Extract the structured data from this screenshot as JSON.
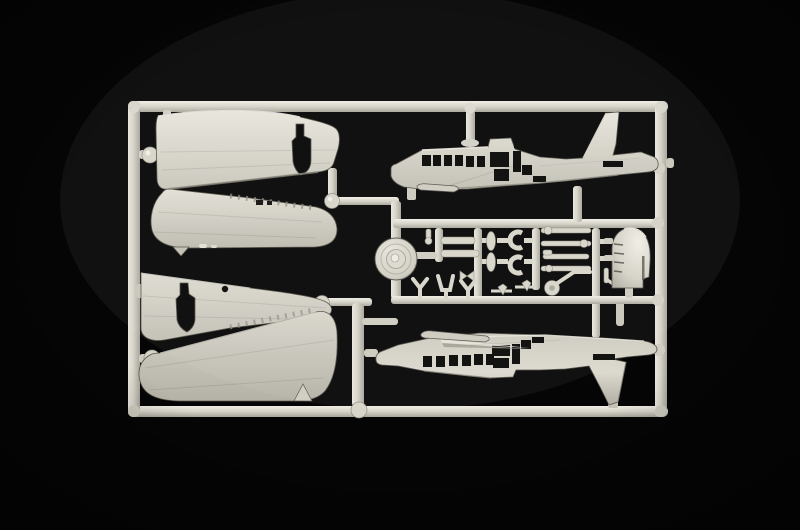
{
  "meta": {
    "description": "Photograph of a light grey injection-molded plastic model kit sprue with aircraft parts on a black background"
  },
  "colors": {
    "background": "#050505",
    "plastic_base": "#d7d4ca",
    "plastic_light": "#eae8de",
    "plastic_mid": "#c6c3b8",
    "plastic_dark": "#a19e92",
    "plastic_deep": "#6e6c63",
    "cutout": "#070706"
  },
  "sprue": {
    "frame_shape": "rectangular runner frame",
    "material": "light grey polystyrene",
    "counts": {
      "wing_halves": 4,
      "fuselage_halves": 2,
      "wheel_discs": 1,
      "cowlings": 1
    }
  },
  "parts": [
    {
      "id": "wing-half-upper-left",
      "label": "tapered wing half with bomb-shaped cutout (upper left)"
    },
    {
      "id": "wing-half-mid-left",
      "label": "large rounded wing half (left)"
    },
    {
      "id": "wing-half-lower-mid-left",
      "label": "tapered wing half with bomb-shaped cutout and round hole (lower left)"
    },
    {
      "id": "wing-half-bottom-left",
      "label": "large rounded wing half with fin tab (bottom left)"
    },
    {
      "id": "fuselage-half-top",
      "label": "fuselage half with cabin windows, door openings and tall tail fin (top right)"
    },
    {
      "id": "fuselage-half-bottom",
      "label": "inverted fuselage half with cabin windows, door openings and tail fin (bottom right)"
    },
    {
      "id": "wheel-disc",
      "label": "round wheel / hub disc on centre runner"
    },
    {
      "id": "cowling",
      "label": "curved cowling piece with louvres (centre right)"
    },
    {
      "id": "small-parts-cluster",
      "label": "cluster of small struts, yokes, rods, masts and a tailwheel leg"
    }
  ]
}
